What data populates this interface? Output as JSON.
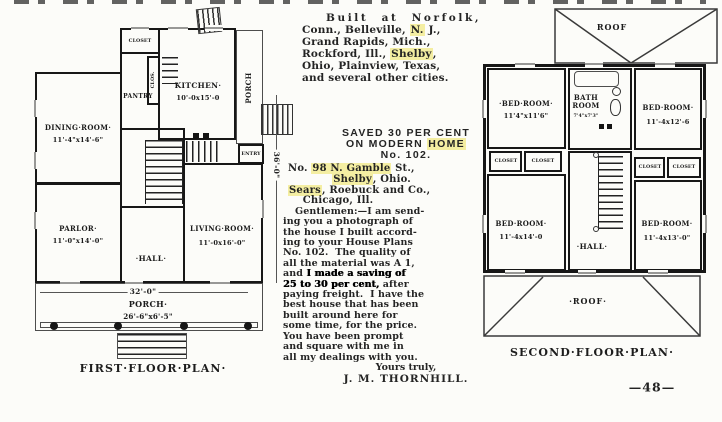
{
  "colors": {
    "paper": "#fcfcf9",
    "ink": "#242424",
    "wall": "#171717",
    "highlight": "#f4eea2"
  },
  "middle_column": {
    "intro_segments": [
      {
        "t": "Built at Norfolk,\n",
        "sp": true
      },
      {
        "t": "Conn., Belleville, "
      },
      {
        "t": "N.",
        "hl": true
      },
      {
        "t": " J.,\nGrand Rapids, Mich.,\nRockford, Ill., "
      },
      {
        "t": "Shelby",
        "hl": true
      },
      {
        "t": ",\nOhio, Plainview, Texas,\nand several other cities."
      }
    ],
    "heading_segments": [
      {
        "t": "SAVED 30 PER CENT\nON MODERN "
      },
      {
        "t": "HOME",
        "hl": true
      },
      {
        "t": "\nNo. 102."
      }
    ],
    "address_segments": [
      {
        "t": "No. "
      },
      {
        "t": "98 N. Gamble",
        "hl": true
      },
      {
        "t": " St.,\n            "
      },
      {
        "t": "Shelby",
        "hl": true
      },
      {
        "t": ", Ohio.\n"
      },
      {
        "t": "Sears",
        "hl": true
      },
      {
        "t": ", Roebuck and Co.,\n    Chicago, Ill."
      }
    ],
    "letter_segments": [
      {
        "t": "Gentlemen:—I am send-\ning you a photograph of\nthe house I built accord-\ning to your House Plans\nNo. 102.  The quality of\nall the material was A 1,\nand "
      },
      {
        "t": "I made a saving of\n25 to 30 per cent,",
        "b": true
      },
      {
        "t": " after\npaying freight.  I have the\nbest house that has been\nbuilt around here for\nsome time, for the price.\nYou have been prompt\nand square with me in\nall my dealings with you."
      }
    ],
    "closing": "Yours truly,",
    "signature": "J. M. THORNHILL."
  },
  "left_plan": {
    "caption": "FIRST·FLOOR·PLAN·",
    "rooms": {
      "closet": "CLOSET",
      "pantry": "PANTRY",
      "clos_small": "CLOS.",
      "kitchen": {
        "name": "KITCHEN·",
        "dim": "10'-0x15'-0"
      },
      "dining": {
        "name": "DINING·ROOM·",
        "dim": "11'-4\"x14'-6\""
      },
      "parlor": {
        "name": "PARLOR·",
        "dim": "11'-0\"x14'-0\""
      },
      "hall": "·HALL·",
      "living": {
        "name": "LIVING·ROOM·",
        "dim": "11'-0x16'-0\""
      },
      "entry": "ENTRY",
      "porch_side": "PORCH",
      "porch_front": {
        "name": "PORCH·",
        "dim": "26'-6\"x6'-5\""
      }
    },
    "dims": {
      "width": "32'-0\"",
      "height": "36'-0\""
    }
  },
  "right_plan": {
    "caption": "SECOND·FLOOR·PLAN·",
    "roof_top": "ROOF",
    "roof_bottom": "·ROOF·",
    "rooms": {
      "bed_tl": {
        "name": "·BED·ROOM·",
        "dim": "11'4\"x11'6\""
      },
      "bath": {
        "name": "BATH\nROOM",
        "dim": "7'4\"x7'3\""
      },
      "bed_tr": {
        "name": "BED·ROOM·",
        "dim": "11'-4x12'-6"
      },
      "bed_bl": {
        "name": "BED·ROOM·",
        "dim": "11'-4x14'-0"
      },
      "bed_br": {
        "name": "BED·ROOM·",
        "dim": "11'-4x13'-0\""
      },
      "hall": "·HALL·",
      "closets": [
        "CLOSET",
        "CLOSET",
        "CLOSET",
        "CLOSET"
      ]
    }
  },
  "page_number": "—48—"
}
